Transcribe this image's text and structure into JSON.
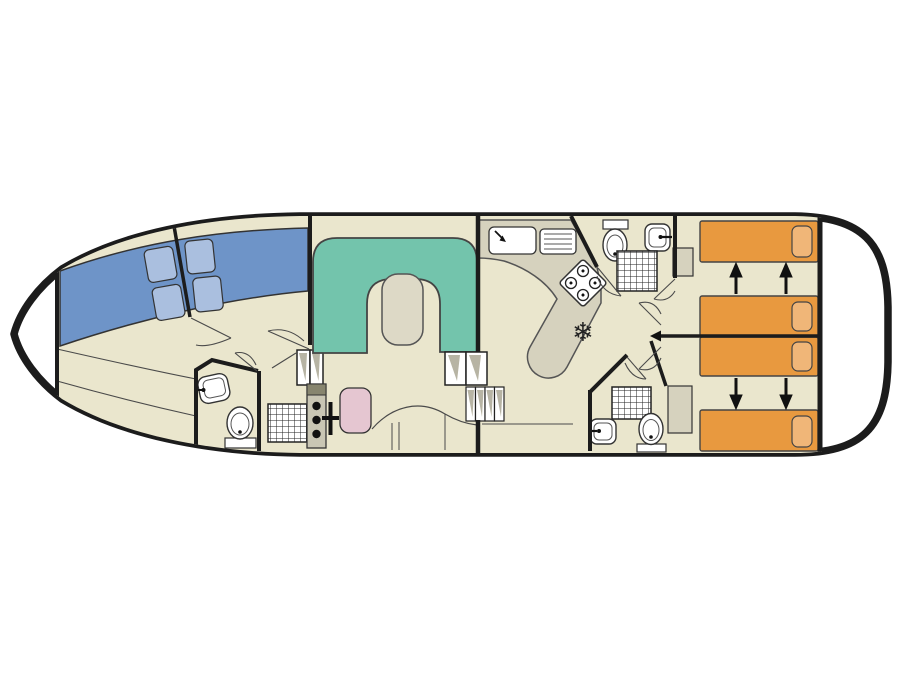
{
  "colors": {
    "hull_outline": "#1c1c1c",
    "deck_white": "#ffffff",
    "floor_beige": "#eae6cd",
    "counter_gray": "#d6d2be",
    "bed_blue": "#6e94c8",
    "pillow_blue": "#aabfdf",
    "sofa_teal": "#73c4ac",
    "table_beige": "#ddd9c6",
    "seat_pink": "#e5c6d1",
    "bed_orange": "#e8993f",
    "pillow_orange": "#f0b678",
    "step_shade": "#b7b4a4",
    "thin_line": "#4a4a4a",
    "wall_black": "#1c1c1c",
    "fixture_white": "#ffffff",
    "console_gray": "#c9c6b4",
    "console_dark": "#87856f",
    "detail_black": "#111111"
  },
  "icons": [
    {
      "name": "snowflake-icon",
      "glyph": "❄"
    }
  ],
  "elements_depicted": [
    "bow-v-berth-two-beds-four-pillows",
    "bow-wc-with-sink-and-toilet",
    "bow-shower-stall",
    "companionway-steps-bow",
    "helm-console-with-wheel-and-seat",
    "saloon-u-shaped-sofa-with-table",
    "saloon-sideboard",
    "companionway-steps-galley",
    "galley-sink-with-drainer",
    "galley-four-burner-hob",
    "galley-fridge-snowflake",
    "top-bathroom-toilet-sink-shower",
    "bottom-bathroom-toilet-sink-shower",
    "two-wardrobes",
    "four-aft-single-beds-with-pillows",
    "convertible-bed-arrows"
  ]
}
